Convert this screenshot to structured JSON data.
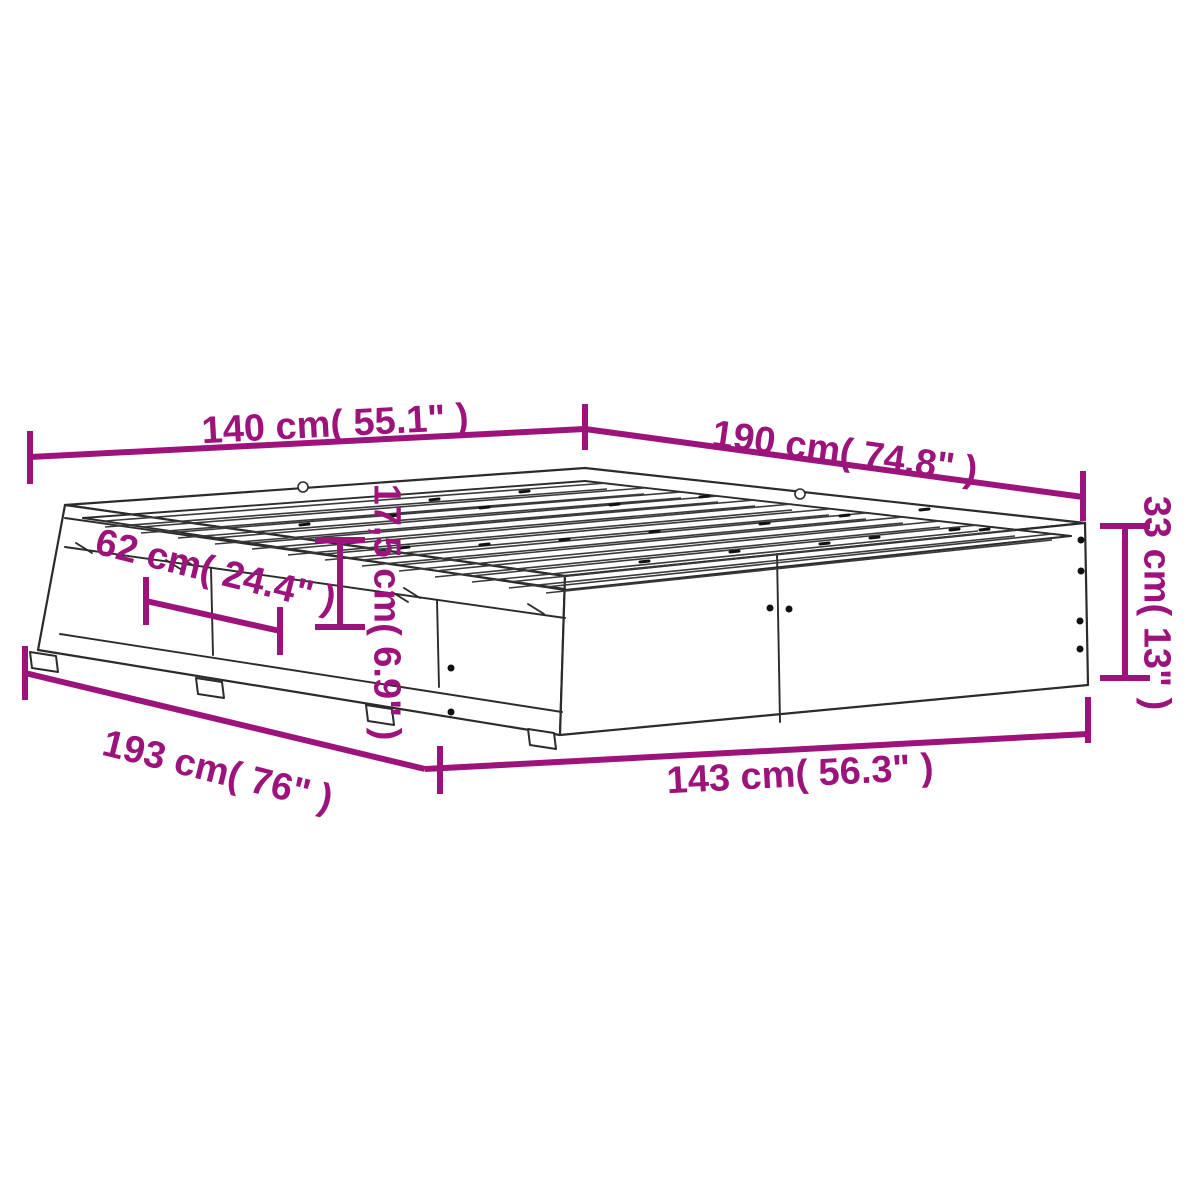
{
  "canvas": {
    "width": 1200,
    "height": 1200,
    "background": "#ffffff"
  },
  "colors": {
    "dimension": "#9B137B",
    "outline": "#2b2b2b"
  },
  "diagram_title": "bed-frame-with-drawers-dimension-diagram",
  "dimensions": [
    {
      "name": "width-top",
      "label": "140 cm( 55.1\" )",
      "label_x": 335,
      "label_y": 423,
      "label_rotate": -3,
      "strokes": [
        [
          30,
          457,
          585,
          429
        ],
        [
          30,
          431,
          30,
          484
        ],
        [
          585,
          404,
          585,
          450
        ]
      ]
    },
    {
      "name": "length-top",
      "label": "190 cm( 74.8\" )",
      "label_x": 845,
      "label_y": 451,
      "label_rotate": 8,
      "strokes": [
        [
          585,
          429,
          1083,
          497
        ],
        [
          1083,
          471,
          1083,
          521
        ]
      ]
    },
    {
      "name": "drawer-width",
      "label": "62 cm( 24.4\" )",
      "label_x": 216,
      "label_y": 570,
      "label_rotate": 14,
      "strokes": [
        [
          146,
          601,
          280,
          631
        ],
        [
          146,
          577,
          146,
          625
        ],
        [
          280,
          607,
          280,
          655
        ]
      ]
    },
    {
      "name": "drawer-height",
      "label": "17,5 cm( 6.9\" )",
      "label_x": 388,
      "label_y": 612,
      "label_rotate": 90,
      "strokes": [
        [
          340,
          540,
          340,
          627
        ],
        [
          315,
          540,
          365,
          540
        ],
        [
          315,
          627,
          365,
          627
        ]
      ]
    },
    {
      "name": "side-height",
      "label": "33 cm( 13\" )",
      "label_x": 1158,
      "label_y": 603,
      "label_rotate": 90,
      "strokes": [
        [
          1125,
          526,
          1125,
          678
        ],
        [
          1100,
          526,
          1150,
          526
        ],
        [
          1100,
          678,
          1150,
          678
        ]
      ]
    },
    {
      "name": "length-bottom",
      "label": "193 cm( 76\" )",
      "label_x": 218,
      "label_y": 770,
      "label_rotate": 14,
      "strokes": [
        [
          25,
          673,
          425,
          769
        ],
        [
          25,
          646,
          25,
          700
        ],
        [
          440,
          746,
          440,
          794
        ]
      ]
    },
    {
      "name": "width-bottom",
      "label": "143 cm( 56.3\" )",
      "label_x": 800,
      "label_y": 773,
      "label_rotate": -3,
      "strokes": [
        [
          425,
          769,
          1088,
          734
        ],
        [
          1088,
          697,
          1088,
          743
        ]
      ]
    }
  ],
  "bed": {
    "faces": [
      {
        "name": "top-surface",
        "points": [
          [
            65,
            505
          ],
          [
            585,
            468
          ],
          [
            1085,
            523
          ],
          [
            565,
            576
          ]
        ]
      },
      {
        "name": "left-drawer-face",
        "points": [
          [
            65,
            505
          ],
          [
            565,
            576
          ],
          [
            560,
            735
          ],
          [
            38,
            650
          ]
        ]
      },
      {
        "name": "right-side-face",
        "points": [
          [
            565,
            576
          ],
          [
            1085,
            523
          ],
          [
            1088,
            685
          ],
          [
            560,
            735
          ]
        ]
      }
    ],
    "feet": [
      [
        [
          30,
          652
        ],
        [
          56,
          656
        ],
        [
          58,
          672
        ],
        [
          32,
          668
        ]
      ],
      [
        [
          196,
          678
        ],
        [
          222,
          682
        ],
        [
          224,
          698
        ],
        [
          198,
          694
        ]
      ],
      [
        [
          366,
          705
        ],
        [
          392,
          709
        ],
        [
          394,
          725
        ],
        [
          368,
          721
        ]
      ],
      [
        [
          528,
          729
        ],
        [
          554,
          733
        ],
        [
          556,
          749
        ],
        [
          530,
          745
        ]
      ]
    ],
    "lines": [
      [
        83,
        518,
        585,
        481
      ],
      [
        585,
        481,
        1071,
        536
      ],
      [
        83,
        518,
        565,
        590
      ],
      [
        565,
        590,
        1071,
        536
      ],
      [
        65,
        518,
        565,
        589
      ],
      [
        65,
        547,
        565,
        618
      ],
      [
        60,
        634,
        562,
        712
      ],
      [
        211,
        568,
        213,
        655
      ],
      [
        437,
        600,
        439,
        687
      ],
      [
        777,
        554,
        780,
        722
      ]
    ],
    "hatches": [
      [
        178,
        556,
        194,
        566
      ],
      [
        166,
        560,
        182,
        570
      ],
      [
        404,
        588,
        420,
        598
      ],
      [
        392,
        592,
        408,
        602
      ],
      [
        76,
        543,
        92,
        553
      ],
      [
        528,
        604,
        544,
        614
      ]
    ],
    "slats": [
      [
        105,
        521,
        607,
        483
      ],
      [
        141,
        527,
        644,
        488
      ],
      [
        178,
        532,
        681,
        492
      ],
      [
        215,
        538,
        718,
        496
      ],
      [
        252,
        543,
        755,
        500
      ],
      [
        288,
        549,
        792,
        504
      ],
      [
        325,
        554,
        829,
        509
      ],
      [
        362,
        560,
        866,
        513
      ],
      [
        399,
        565,
        903,
        517
      ],
      [
        435,
        571,
        940,
        521
      ],
      [
        472,
        576,
        978,
        525
      ],
      [
        509,
        582,
        1015,
        530
      ],
      [
        546,
        587,
        1052,
        534
      ]
    ],
    "slat_thickness": 6,
    "dashes": [
      [
        430,
        500
      ],
      [
        520,
        492
      ],
      [
        300,
        525
      ],
      [
        390,
        516
      ],
      [
        480,
        508
      ],
      [
        610,
        505
      ],
      [
        700,
        497
      ],
      [
        560,
        540
      ],
      [
        650,
        532
      ],
      [
        760,
        524
      ],
      [
        840,
        516
      ],
      [
        870,
        538
      ],
      [
        950,
        530
      ],
      [
        730,
        552
      ],
      [
        820,
        544
      ],
      [
        480,
        545
      ],
      [
        400,
        548
      ],
      [
        640,
        562
      ],
      [
        920,
        510
      ],
      [
        980,
        530
      ]
    ],
    "circles": [
      [
        303,
        487
      ],
      [
        800,
        494
      ]
    ],
    "dots": [
      [
        1081,
        540
      ],
      [
        1081,
        571
      ],
      [
        1080,
        621
      ],
      [
        1080,
        649
      ],
      [
        770,
        608
      ],
      [
        789,
        609
      ],
      [
        451,
        668
      ],
      [
        451,
        712
      ]
    ]
  }
}
